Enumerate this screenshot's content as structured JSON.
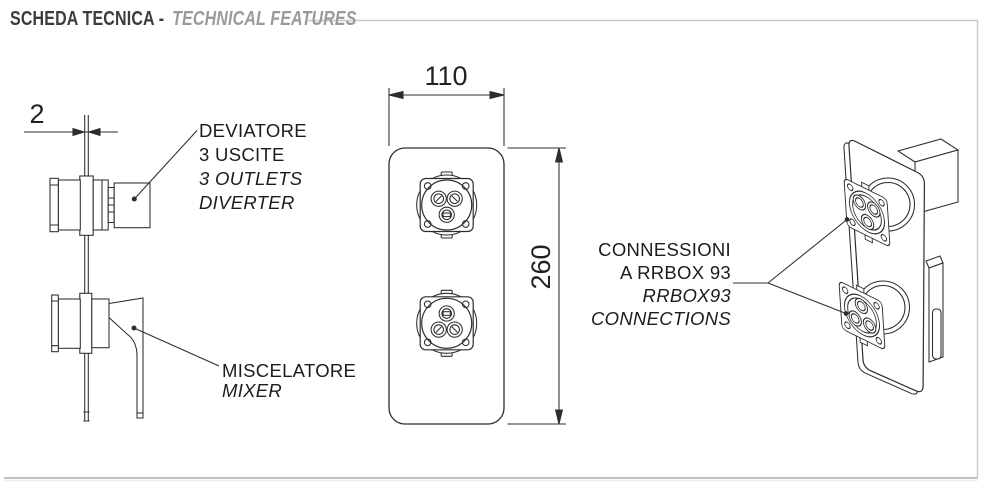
{
  "header": {
    "title_it": "SCHEDA TECNICA -",
    "title_en": "TECHNICAL FEATURES"
  },
  "side_view": {
    "dim_plate_thickness": "2",
    "diverter_label": {
      "line1": "DEVIATORE",
      "line2": "3 USCITE",
      "line3": "3 OUTLETS",
      "line4": "DIVERTER"
    },
    "mixer_label": {
      "line1": "MISCELATORE",
      "line2": "MIXER"
    }
  },
  "front_view": {
    "dim_width": "110",
    "dim_height": "260"
  },
  "iso_view": {
    "connections_label": {
      "line1": "CONNESSIONI",
      "line2": "A RRBOX 93",
      "line3": "RRBOX93",
      "line4": "CONNECTIONS"
    }
  },
  "colors": {
    "background": "#ffffff",
    "drawing_line": "#2d2d2d",
    "title_primary": "#3c3c3c",
    "title_secondary": "#9a9a9a",
    "frame_border": "#c8c8c8"
  }
}
